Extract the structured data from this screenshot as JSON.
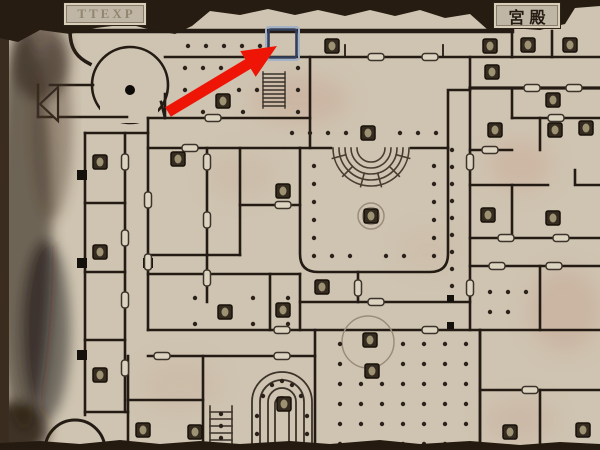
{
  "screen": {
    "width": 600,
    "height": 450
  },
  "tabs": {
    "left_label": "TTEXP",
    "right_label": "宮殿"
  },
  "overlay": {
    "arrow_color": "#ee1506",
    "arrow_edge_color": "#c01005",
    "highlight_outer": "#a3b2c6",
    "highlight_inner": "#323f5c"
  },
  "palette": {
    "parchment": "#cfc4b1",
    "ink": "#241c14",
    "torn_edge": "#261c11",
    "stain_pink": "#c79d8d",
    "smudge_dark": "#3a2e22",
    "door_fill": "#ddd3c1",
    "object_fill": "#352b21"
  }
}
